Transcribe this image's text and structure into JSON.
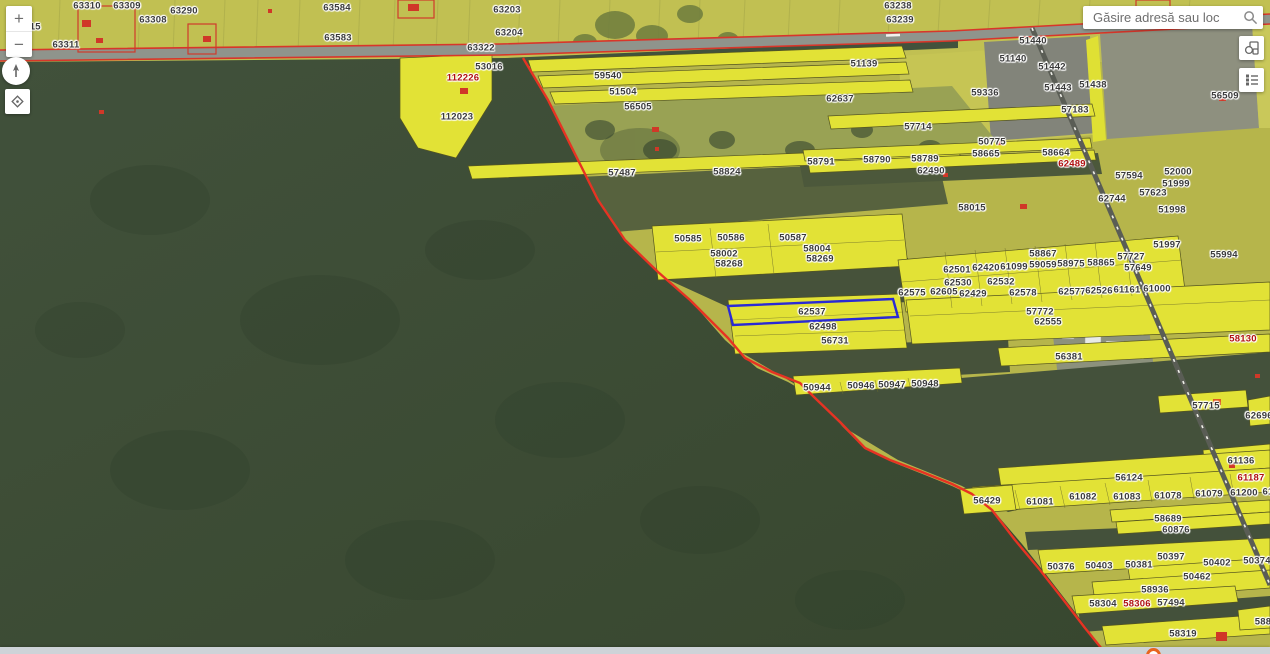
{
  "ui": {
    "search": {
      "placeholder": "Găsire adresă sau loc"
    },
    "zoom_in_label": "+",
    "zoom_out_label": "−"
  },
  "colors": {
    "selection_blue": "#2a2ad4",
    "boundary_red": "#e23a28",
    "highlight_parcel_yellow": "#e2e236",
    "forest_green": "#3e4e39",
    "farmland_olive": "#b6b54b",
    "label_dark": "#3a3a3a",
    "label_red": "#b01010"
  },
  "parcels": [
    {
      "n": "63310",
      "x": 87,
      "y": 6
    },
    {
      "n": "63309",
      "x": 127,
      "y": 6
    },
    {
      "n": "63315",
      "x": 27,
      "y": 27
    },
    {
      "n": "63311",
      "x": 66,
      "y": 45
    },
    {
      "n": "63308",
      "x": 153,
      "y": 20
    },
    {
      "n": "63290",
      "x": 184,
      "y": 11
    },
    {
      "n": "63584",
      "x": 337,
      "y": 8
    },
    {
      "n": "63583",
      "x": 338,
      "y": 38
    },
    {
      "n": "63203",
      "x": 507,
      "y": 10
    },
    {
      "n": "63204",
      "x": 509,
      "y": 33
    },
    {
      "n": "63322",
      "x": 481,
      "y": 48
    },
    {
      "n": "63238",
      "x": 898,
      "y": 6
    },
    {
      "n": "63239",
      "x": 900,
      "y": 20
    },
    {
      "n": "53016",
      "x": 489,
      "y": 67
    },
    {
      "n": "112226",
      "x": 463,
      "y": 78,
      "red": true
    },
    {
      "n": "112023",
      "x": 457,
      "y": 117
    },
    {
      "n": "59540",
      "x": 608,
      "y": 76
    },
    {
      "n": "51504",
      "x": 623,
      "y": 92
    },
    {
      "n": "56505",
      "x": 638,
      "y": 107
    },
    {
      "n": "62637",
      "x": 840,
      "y": 99
    },
    {
      "n": "51139",
      "x": 864,
      "y": 64
    },
    {
      "n": "51440",
      "x": 1033,
      "y": 41
    },
    {
      "n": "51140",
      "x": 1013,
      "y": 59
    },
    {
      "n": "51442",
      "x": 1052,
      "y": 67
    },
    {
      "n": "51443",
      "x": 1058,
      "y": 88
    },
    {
      "n": "51438",
      "x": 1093,
      "y": 85
    },
    {
      "n": "57183",
      "x": 1075,
      "y": 110
    },
    {
      "n": "59336",
      "x": 985,
      "y": 93
    },
    {
      "n": "56509",
      "x": 1225,
      "y": 96
    },
    {
      "n": "57714",
      "x": 918,
      "y": 127
    },
    {
      "n": "50775",
      "x": 992,
      "y": 142
    },
    {
      "n": "58665",
      "x": 986,
      "y": 154
    },
    {
      "n": "58664",
      "x": 1056,
      "y": 153
    },
    {
      "n": "58791",
      "x": 821,
      "y": 162
    },
    {
      "n": "58790",
      "x": 877,
      "y": 160
    },
    {
      "n": "58789",
      "x": 925,
      "y": 159
    },
    {
      "n": "62490",
      "x": 931,
      "y": 171
    },
    {
      "n": "62489",
      "x": 1072,
      "y": 164,
      "red": true
    },
    {
      "n": "62744",
      "x": 1112,
      "y": 199
    },
    {
      "n": "57594",
      "x": 1129,
      "y": 176
    },
    {
      "n": "52000",
      "x": 1178,
      "y": 172
    },
    {
      "n": "51999",
      "x": 1176,
      "y": 184
    },
    {
      "n": "57623",
      "x": 1153,
      "y": 193
    },
    {
      "n": "51998",
      "x": 1172,
      "y": 210
    },
    {
      "n": "57487",
      "x": 622,
      "y": 173
    },
    {
      "n": "58824",
      "x": 727,
      "y": 172
    },
    {
      "n": "58015",
      "x": 972,
      "y": 208
    },
    {
      "n": "51997",
      "x": 1167,
      "y": 245
    },
    {
      "n": "55994",
      "x": 1224,
      "y": 255
    },
    {
      "n": "58867",
      "x": 1043,
      "y": 254
    },
    {
      "n": "57727",
      "x": 1131,
      "y": 257
    },
    {
      "n": "57649",
      "x": 1138,
      "y": 268
    },
    {
      "n": "58865",
      "x": 1101,
      "y": 263
    },
    {
      "n": "58975",
      "x": 1071,
      "y": 264
    },
    {
      "n": "59059",
      "x": 1043,
      "y": 265
    },
    {
      "n": "61099",
      "x": 1014,
      "y": 267
    },
    {
      "n": "62420",
      "x": 986,
      "y": 268
    },
    {
      "n": "62501",
      "x": 957,
      "y": 270
    },
    {
      "n": "62530",
      "x": 958,
      "y": 283
    },
    {
      "n": "62532",
      "x": 1001,
      "y": 282
    },
    {
      "n": "62575",
      "x": 912,
      "y": 293
    },
    {
      "n": "62605",
      "x": 944,
      "y": 292
    },
    {
      "n": "62429",
      "x": 973,
      "y": 294
    },
    {
      "n": "62578",
      "x": 1023,
      "y": 293
    },
    {
      "n": "62577",
      "x": 1072,
      "y": 292
    },
    {
      "n": "62526",
      "x": 1099,
      "y": 291
    },
    {
      "n": "61161",
      "x": 1127,
      "y": 290
    },
    {
      "n": "61000",
      "x": 1157,
      "y": 289
    },
    {
      "n": "50585",
      "x": 688,
      "y": 239
    },
    {
      "n": "50586",
      "x": 731,
      "y": 238
    },
    {
      "n": "50587",
      "x": 793,
      "y": 238
    },
    {
      "n": "58004",
      "x": 817,
      "y": 249
    },
    {
      "n": "58002",
      "x": 724,
      "y": 254
    },
    {
      "n": "58269",
      "x": 820,
      "y": 259
    },
    {
      "n": "58268",
      "x": 729,
      "y": 264
    },
    {
      "n": "62537",
      "x": 812,
      "y": 312
    },
    {
      "n": "62498",
      "x": 823,
      "y": 327
    },
    {
      "n": "56731",
      "x": 835,
      "y": 341
    },
    {
      "n": "57772",
      "x": 1040,
      "y": 312
    },
    {
      "n": "62555",
      "x": 1048,
      "y": 322
    },
    {
      "n": "56381",
      "x": 1069,
      "y": 357
    },
    {
      "n": "58130",
      "x": 1243,
      "y": 339,
      "red": true
    },
    {
      "n": "50944",
      "x": 817,
      "y": 388
    },
    {
      "n": "50946",
      "x": 861,
      "y": 386
    },
    {
      "n": "50947",
      "x": 892,
      "y": 385
    },
    {
      "n": "50948",
      "x": 925,
      "y": 384
    },
    {
      "n": "57715",
      "x": 1206,
      "y": 406
    },
    {
      "n": "62696",
      "x": 1259,
      "y": 416
    },
    {
      "n": "61136",
      "x": 1241,
      "y": 461
    },
    {
      "n": "56124",
      "x": 1129,
      "y": 478
    },
    {
      "n": "61187",
      "x": 1251,
      "y": 478,
      "red": true
    },
    {
      "n": "56429",
      "x": 987,
      "y": 501
    },
    {
      "n": "61081",
      "x": 1040,
      "y": 502
    },
    {
      "n": "61082",
      "x": 1083,
      "y": 497
    },
    {
      "n": "61083",
      "x": 1127,
      "y": 497
    },
    {
      "n": "61078",
      "x": 1168,
      "y": 496
    },
    {
      "n": "61079",
      "x": 1209,
      "y": 494
    },
    {
      "n": "61200",
      "x": 1244,
      "y": 493
    },
    {
      "n": "61",
      "x": 1268,
      "y": 492
    },
    {
      "n": "58689",
      "x": 1168,
      "y": 519
    },
    {
      "n": "60876",
      "x": 1176,
      "y": 530
    },
    {
      "n": "50397",
      "x": 1171,
      "y": 557
    },
    {
      "n": "50376",
      "x": 1061,
      "y": 567
    },
    {
      "n": "50403",
      "x": 1099,
      "y": 566
    },
    {
      "n": "50381",
      "x": 1139,
      "y": 565
    },
    {
      "n": "50402",
      "x": 1217,
      "y": 563
    },
    {
      "n": "50374",
      "x": 1257,
      "y": 561
    },
    {
      "n": "50462",
      "x": 1197,
      "y": 577
    },
    {
      "n": "58936",
      "x": 1155,
      "y": 590
    },
    {
      "n": "58304",
      "x": 1103,
      "y": 604
    },
    {
      "n": "58306",
      "x": 1137,
      "y": 604,
      "red": true
    },
    {
      "n": "57494",
      "x": 1171,
      "y": 603
    },
    {
      "n": "58319",
      "x": 1183,
      "y": 634
    },
    {
      "n": "588",
      "x": 1263,
      "y": 622
    }
  ]
}
